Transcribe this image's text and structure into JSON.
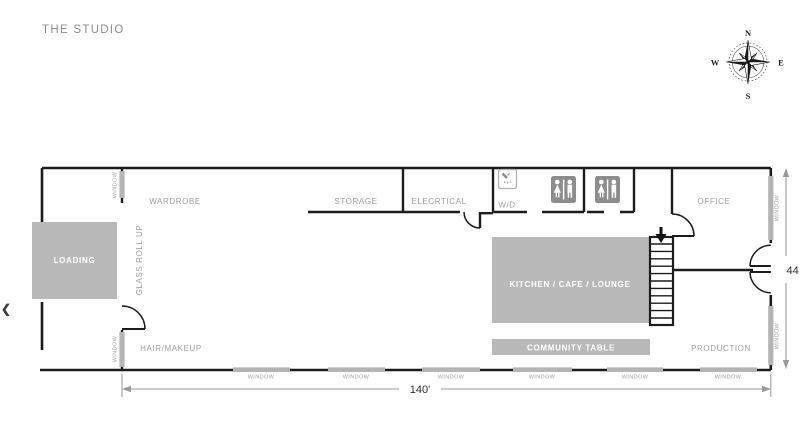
{
  "page": {
    "title": "THE STUDIO"
  },
  "nav": {
    "prev_label": "❮"
  },
  "compass": {
    "north": "N",
    "east": "E",
    "south": "S",
    "west": "W"
  },
  "rooms": {
    "wardrobe": "WARDROBE",
    "storage": "STORAGE",
    "electrical": "ELECRTICAL",
    "wd": "W/D",
    "office": "OFFICE",
    "hair_makeup": "HAIR/MAKEUP",
    "production": "PRODUCTION",
    "glass_roll_up": "GLASS ROLL UP"
  },
  "areas": {
    "loading": "LOADING",
    "kitchen": "KITCHEN / CAFE / LOUNGE",
    "community_table": "COMMUNITY TABLE"
  },
  "windows": {
    "label": "WINDOW"
  },
  "dimensions": {
    "width": "140'",
    "depth": "44"
  },
  "icons": {
    "restroom": "restroom-sign-icon",
    "shower": "shower-icon",
    "stairs_arrow": "stairs-down-arrow-icon",
    "compass_rose": "compass-rose-icon",
    "prev_arrow": "chevron-left-icon"
  },
  "colors": {
    "wall": "#1c1c1c",
    "area_fill": "#b9b9b9",
    "window_fill": "#b4b4b4",
    "icon_fill": "#8d8d8d",
    "label_text": "#9e9e9e",
    "dimension_line": "#9a9a9a",
    "dimension_text": "#2e2e2e",
    "white_text": "#ffffff"
  }
}
